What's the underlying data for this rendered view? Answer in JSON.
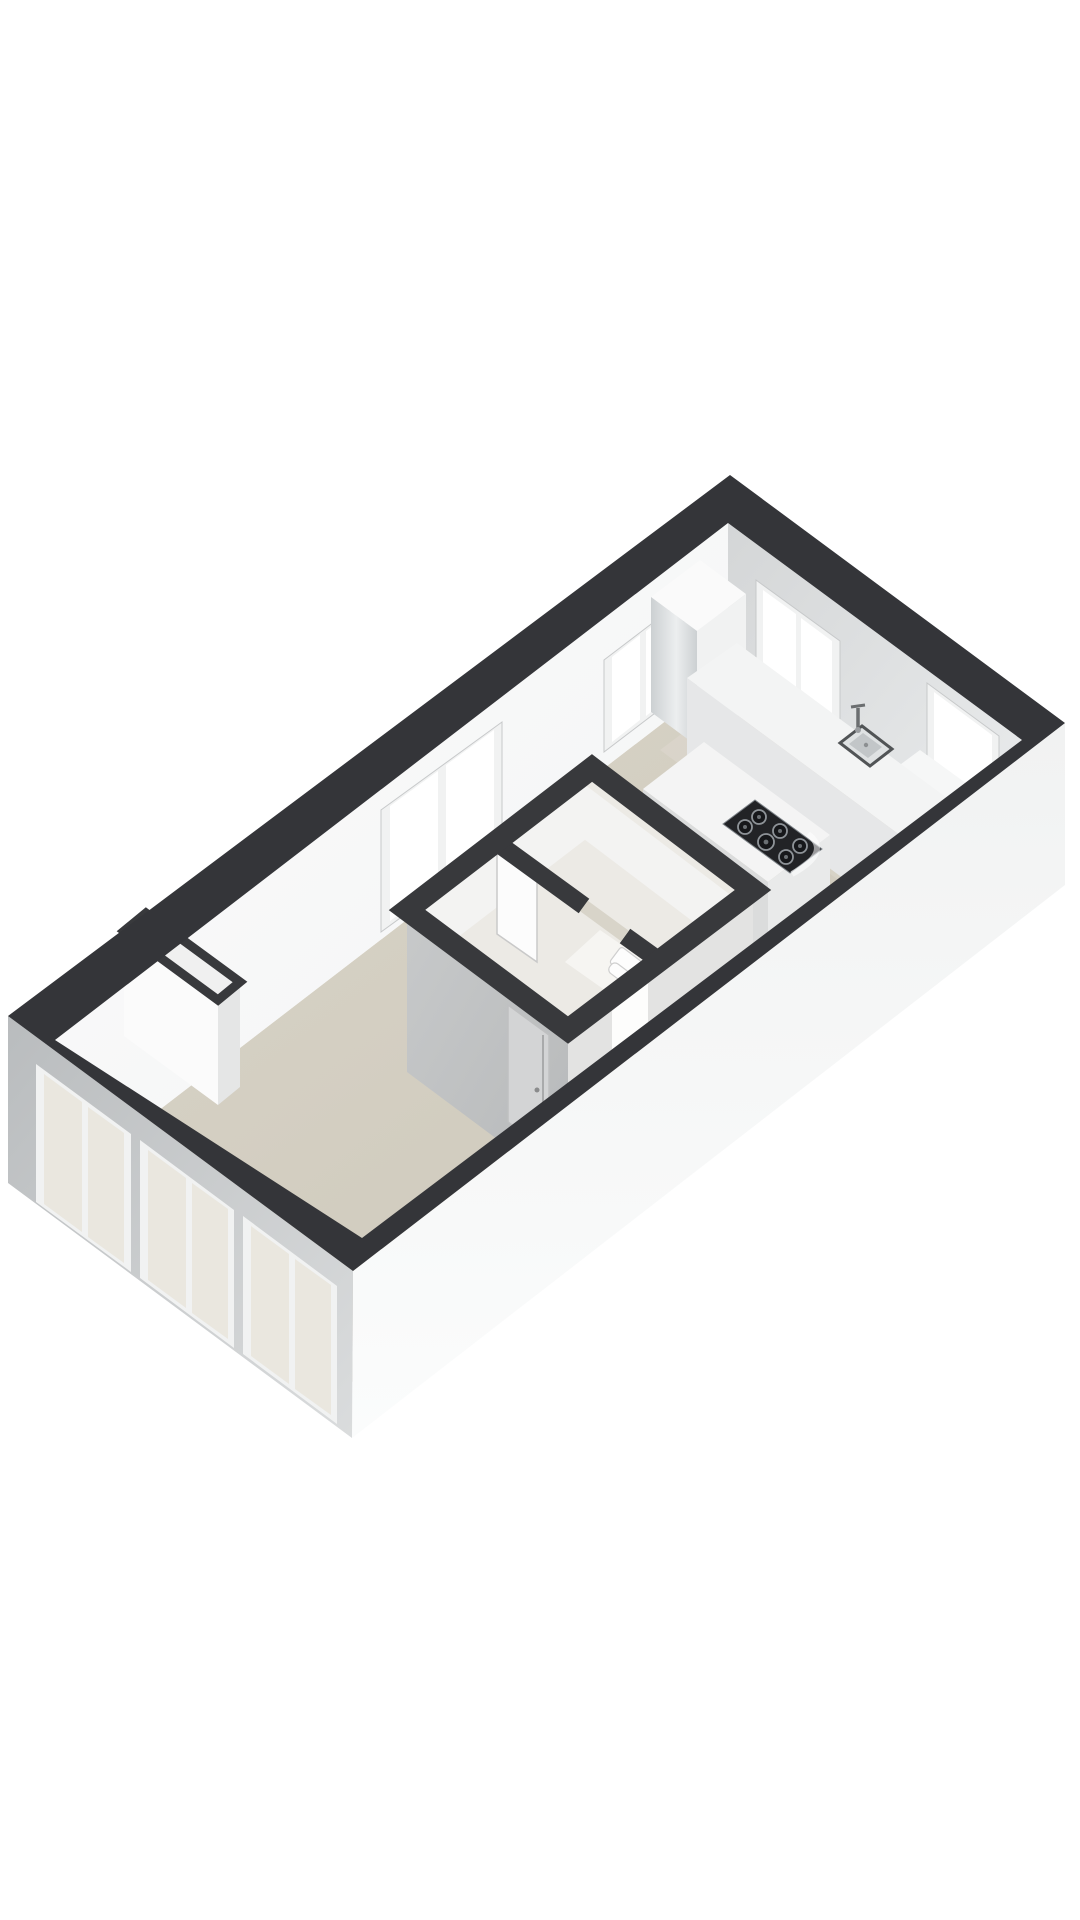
{
  "scene": {
    "type": "3d-floorplan-render",
    "background": "#ffffff",
    "palette": {
      "wall_cut": "#343539",
      "core_cut": "#38393c",
      "floor_light": "#dad5c9",
      "floor_dark": "#cbc6b8",
      "nw_wall_a": "#f3f4f4",
      "nw_wall_b": "#fbfbfc",
      "ne_wall_a": "#d4d6d7",
      "ne_wall_b": "#ebedee",
      "sw_facade_a": "#b9bcbe",
      "sw_facade_b": "#dadcdd",
      "se_facade_a": "#f1f2f2",
      "se_facade_b": "#fbfcfc",
      "window_frame": "#f1f2f2",
      "window_frame_line": "#c7c9ca",
      "window_glass_bright": "#ffffff",
      "window_glass_tint": "#eae7df",
      "cabinet_gloss_a": "#ccd0d2",
      "cabinet_gloss_b": "#eceeef",
      "cabinet_front": "#f1f2f2",
      "counter_top": "#f3f4f4",
      "counter_front": "#e6e7e8",
      "island_top": "#f4f4f4",
      "island_sw": "#dbdcdc",
      "island_se": "#e9eaea",
      "cooktop_body": "#222326",
      "cooktop_burner": "#16171a",
      "cooktop_ring": "#8e9398",
      "sink_rim": "#515456",
      "sink_body": "#dfe2e3",
      "sink_basin": "#c2c6c8",
      "metal": "#6b6e70",
      "core_floor": "#eceae5",
      "core_face_in": "#f3f3f2",
      "core_face_se": "#e3e3e2",
      "core_wall_sw_a": "#c7c9ca",
      "core_wall_sw_b": "#b7b9ba",
      "core_door": "#d3d4d5",
      "door_white": "#fcfcfc",
      "lit_opening": "#fdfdfc",
      "toilet": "#fdfdfd",
      "shaft_inner": "#f0f0f0",
      "shaft_front": "#fbfbfb",
      "shaft_side": "#e5e6e6",
      "sill": "#f6f7f7"
    },
    "objects": [
      "exterior-wall-cut-band",
      "nw-interior-wall",
      "ne-interior-wall",
      "sw-facade-with-windows",
      "se-facade",
      "living-room-floor",
      "kitchen-floor",
      "kitchen-window-nw",
      "living-room-window-nw",
      "kitchen-window-ne",
      "kitchen-window-ne-deep-sill",
      "tall-cabinet",
      "kitchen-counter",
      "kitchen-sink",
      "faucet",
      "kitchen-island",
      "cooktop-6-burners",
      "bathroom-core",
      "interior-door-gray",
      "interior-door-white",
      "toilet",
      "duct-shaft",
      "facade-window-group-1",
      "facade-window-group-2",
      "facade-window-group-3"
    ]
  }
}
